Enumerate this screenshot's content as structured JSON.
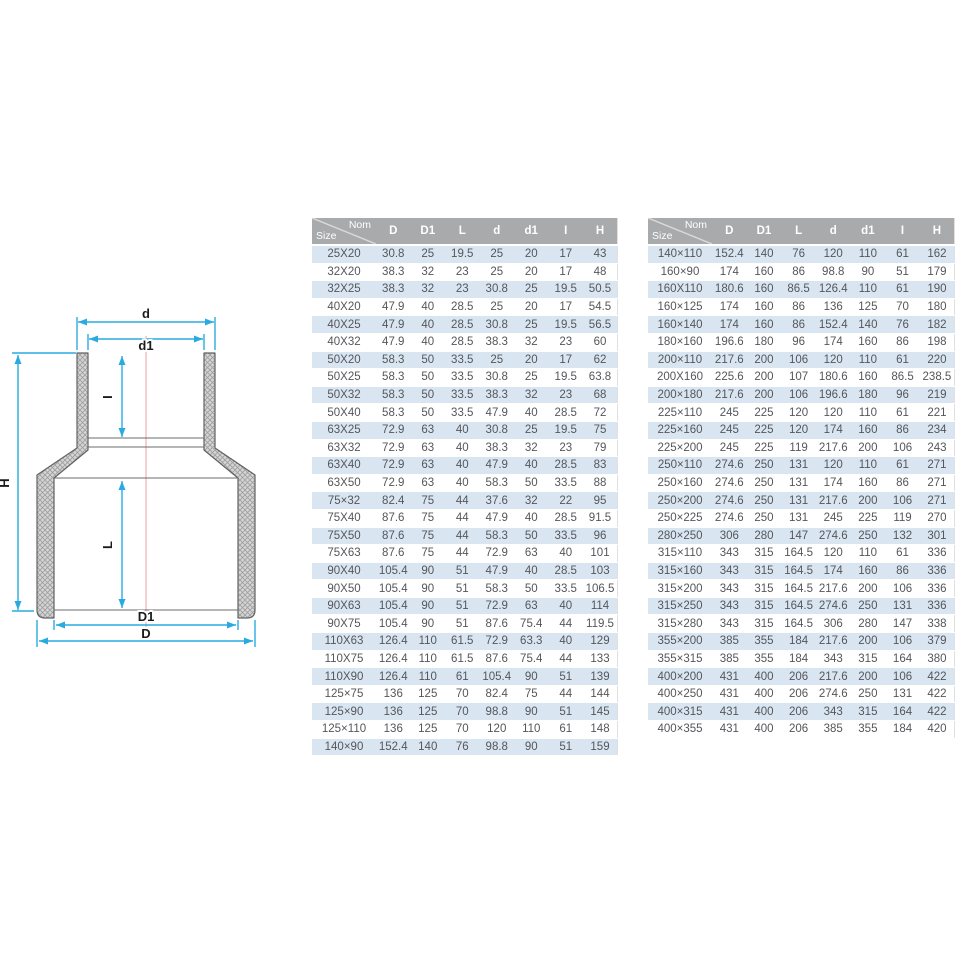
{
  "page": {
    "title": "PVC reducer coupling dimension sheet"
  },
  "colors": {
    "header_bg": "#a8aaab",
    "header_text": "#ffffff",
    "row_alt": "#d9e6f2",
    "row_text": "#54565a",
    "dim": "#29abe2",
    "centerline": "#f3bcbc",
    "outline": "#5f6163"
  },
  "diagram": {
    "description": "cross-section technical drawing of a concentric reducer fitting",
    "labels": {
      "d": "d",
      "d1": "d1",
      "i": "I",
      "h": "H",
      "l": "L",
      "big_d1": "D1",
      "big_d": "D"
    },
    "dimension_color": "#29abe2",
    "centerline_color": "#f3bcbc"
  },
  "tables": [
    {
      "position": "left",
      "size_label": "Size",
      "nom_label": "Nom",
      "columns": [
        "D",
        "D1",
        "L",
        "d",
        "d1",
        "I",
        "H"
      ],
      "rows": [
        [
          "25X20",
          30.8,
          25,
          19.5,
          25,
          20,
          17,
          43
        ],
        [
          "32X20",
          38.3,
          32,
          23,
          25,
          20,
          17,
          48
        ],
        [
          "32X25",
          38.3,
          32,
          23,
          30.8,
          25,
          19.5,
          50.5
        ],
        [
          "40X20",
          47.9,
          40,
          28.5,
          25,
          20,
          17,
          54.5
        ],
        [
          "40X25",
          47.9,
          40,
          28.5,
          30.8,
          25,
          19.5,
          56.5
        ],
        [
          "40X32",
          47.9,
          40,
          28.5,
          38.3,
          32,
          23,
          60
        ],
        [
          "50X20",
          58.3,
          50,
          33.5,
          25,
          20,
          17,
          62
        ],
        [
          "50X25",
          58.3,
          50,
          33.5,
          30.8,
          25,
          19.5,
          63.8
        ],
        [
          "50X32",
          58.3,
          50,
          33.5,
          38.3,
          32,
          23,
          68
        ],
        [
          "50X40",
          58.3,
          50,
          33.5,
          47.9,
          40,
          28.5,
          72
        ],
        [
          "63X25",
          72.9,
          63,
          40,
          30.8,
          25,
          19.5,
          75
        ],
        [
          "63X32",
          72.9,
          63,
          40,
          38.3,
          32,
          23,
          79
        ],
        [
          "63X40",
          72.9,
          63,
          40,
          47.9,
          40,
          28.5,
          83
        ],
        [
          "63X50",
          72.9,
          63,
          40,
          58.3,
          50,
          33.5,
          88
        ],
        [
          "75×32",
          82.4,
          75,
          44,
          37.6,
          32,
          22,
          95
        ],
        [
          "75X40",
          87.6,
          75,
          44,
          47.9,
          40,
          28.5,
          91.5
        ],
        [
          "75X50",
          87.6,
          75,
          44,
          58.3,
          50,
          33.5,
          96
        ],
        [
          "75X63",
          87.6,
          75,
          44,
          72.9,
          63,
          40,
          101
        ],
        [
          "90X40",
          105.4,
          90,
          51,
          47.9,
          40,
          28.5,
          103
        ],
        [
          "90X50",
          105.4,
          90,
          51,
          58.3,
          50,
          33.5,
          106.5
        ],
        [
          "90X63",
          105.4,
          90,
          51,
          72.9,
          63,
          40,
          114
        ],
        [
          "90X75",
          105.4,
          90,
          51,
          87.6,
          75.4,
          44,
          119.5
        ],
        [
          "110X63",
          126.4,
          110,
          61.5,
          72.9,
          63.3,
          40,
          129
        ],
        [
          "110X75",
          126.4,
          110,
          61.5,
          87.6,
          75.4,
          44,
          133
        ],
        [
          "110X90",
          126.4,
          110,
          61,
          105.4,
          90,
          51,
          139
        ],
        [
          "125×75",
          136,
          125,
          70,
          82.4,
          75,
          44,
          144
        ],
        [
          "125×90",
          136,
          125,
          70,
          98.8,
          90,
          51,
          145
        ],
        [
          "125×110",
          136,
          125,
          70,
          120,
          110,
          61,
          148
        ],
        [
          "140×90",
          152.4,
          140,
          76,
          98.8,
          90,
          51,
          159
        ]
      ]
    },
    {
      "position": "right",
      "size_label": "Size",
      "nom_label": "Nom",
      "columns": [
        "D",
        "D1",
        "L",
        "d",
        "d1",
        "I",
        "H"
      ],
      "rows": [
        [
          "140×110",
          152.4,
          140,
          76,
          120,
          110,
          61,
          162
        ],
        [
          "160×90",
          174,
          160,
          86,
          98.8,
          90,
          51,
          179
        ],
        [
          "160X110",
          180.6,
          160,
          86.5,
          126.4,
          110,
          61,
          190
        ],
        [
          "160×125",
          174,
          160,
          86,
          136,
          125,
          70,
          180
        ],
        [
          "160×140",
          174,
          160,
          86,
          152.4,
          140,
          76,
          182
        ],
        [
          "180×160",
          196.6,
          180,
          96,
          174,
          160,
          86,
          198
        ],
        [
          "200×110",
          217.6,
          200,
          106,
          120,
          110,
          61,
          220
        ],
        [
          "200X160",
          225.6,
          200,
          107,
          180.6,
          160,
          86.5,
          238.5
        ],
        [
          "200×180",
          217.6,
          200,
          106,
          196.6,
          180,
          96,
          219
        ],
        [
          "225×110",
          245,
          225,
          120,
          120,
          110,
          61,
          221
        ],
        [
          "225×160",
          245,
          225,
          120,
          174,
          160,
          86,
          234
        ],
        [
          "225×200",
          245,
          225,
          119,
          217.6,
          200,
          106,
          243
        ],
        [
          "250×110",
          274.6,
          250,
          131,
          120,
          110,
          61,
          271
        ],
        [
          "250×160",
          274.6,
          250,
          131,
          174,
          160,
          86,
          271
        ],
        [
          "250×200",
          274.6,
          250,
          131,
          217.6,
          200,
          106,
          271
        ],
        [
          "250×225",
          274.6,
          250,
          131,
          245,
          225,
          119,
          270
        ],
        [
          "280×250",
          306,
          280,
          147,
          274.6,
          250,
          132,
          301
        ],
        [
          "315×110",
          343,
          315,
          164.5,
          120,
          110,
          61,
          336
        ],
        [
          "315×160",
          343,
          315,
          164.5,
          174,
          160,
          86,
          336
        ],
        [
          "315×200",
          343,
          315,
          164.5,
          217.6,
          200,
          106,
          336
        ],
        [
          "315×250",
          343,
          315,
          164.5,
          274.6,
          250,
          131,
          336
        ],
        [
          "315×280",
          343,
          315,
          164.5,
          306,
          280,
          147,
          338
        ],
        [
          "355×200",
          385,
          355,
          184,
          217.6,
          200,
          106,
          379
        ],
        [
          "355×315",
          385,
          355,
          184,
          343,
          315,
          164,
          380
        ],
        [
          "400×200",
          431,
          400,
          206,
          217.6,
          200,
          106,
          422
        ],
        [
          "400×250",
          431,
          400,
          206,
          274.6,
          250,
          131,
          422
        ],
        [
          "400×315",
          431,
          400,
          206,
          343,
          315,
          164,
          422
        ],
        [
          "400×355",
          431,
          400,
          206,
          385,
          355,
          184,
          420
        ]
      ]
    }
  ]
}
